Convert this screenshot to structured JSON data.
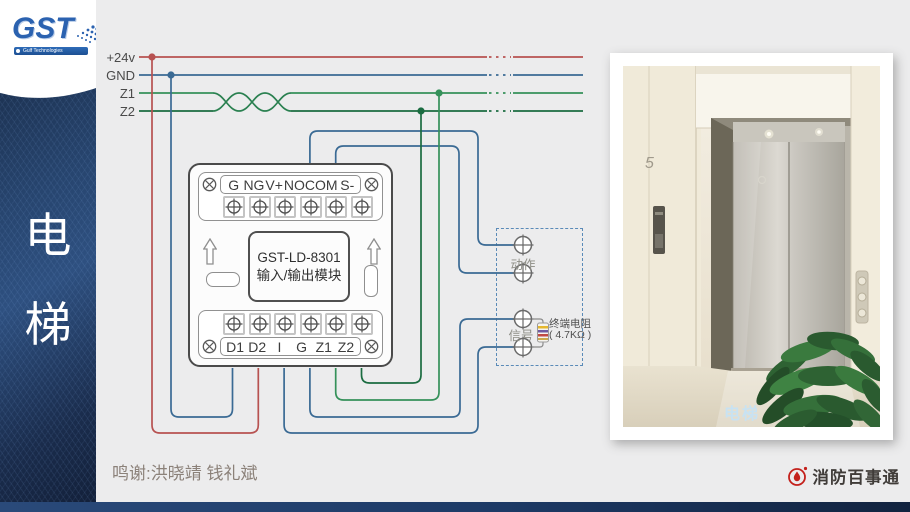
{
  "sidebar": {
    "logo_text": "GST",
    "logo_tagline": "Gulf Technologies",
    "vertical_title": [
      "电",
      "梯"
    ]
  },
  "bus": {
    "labels": [
      "+24v",
      "GND",
      "Z1",
      "Z2"
    ]
  },
  "module": {
    "top_terminals": [
      "G",
      "NG",
      "V+",
      "NO",
      "COM",
      "S-"
    ],
    "bottom_terminals": [
      "D1",
      "D2",
      "I",
      "G",
      "Z1",
      "Z2"
    ],
    "model": "GST-LD-8301",
    "name": "输入/输出模块"
  },
  "control_box": {
    "action_label": "动作",
    "signal_label": "信号",
    "resistor_line1": "终端电阻",
    "resistor_line2": "( 4.7KΩ )"
  },
  "photo": {
    "caption": "电梯"
  },
  "footer": {
    "credits": "鸣谢:洪晓靖 钱礼斌",
    "brand": "消防百事通"
  },
  "colors": {
    "wire_red": "#b75251",
    "wire_blue": "#3a6a94",
    "wire_green_light": "#35915a",
    "wire_green_dark": "#1b6c41",
    "navy": "#1d3a66",
    "brand_red": "#c4211c"
  }
}
